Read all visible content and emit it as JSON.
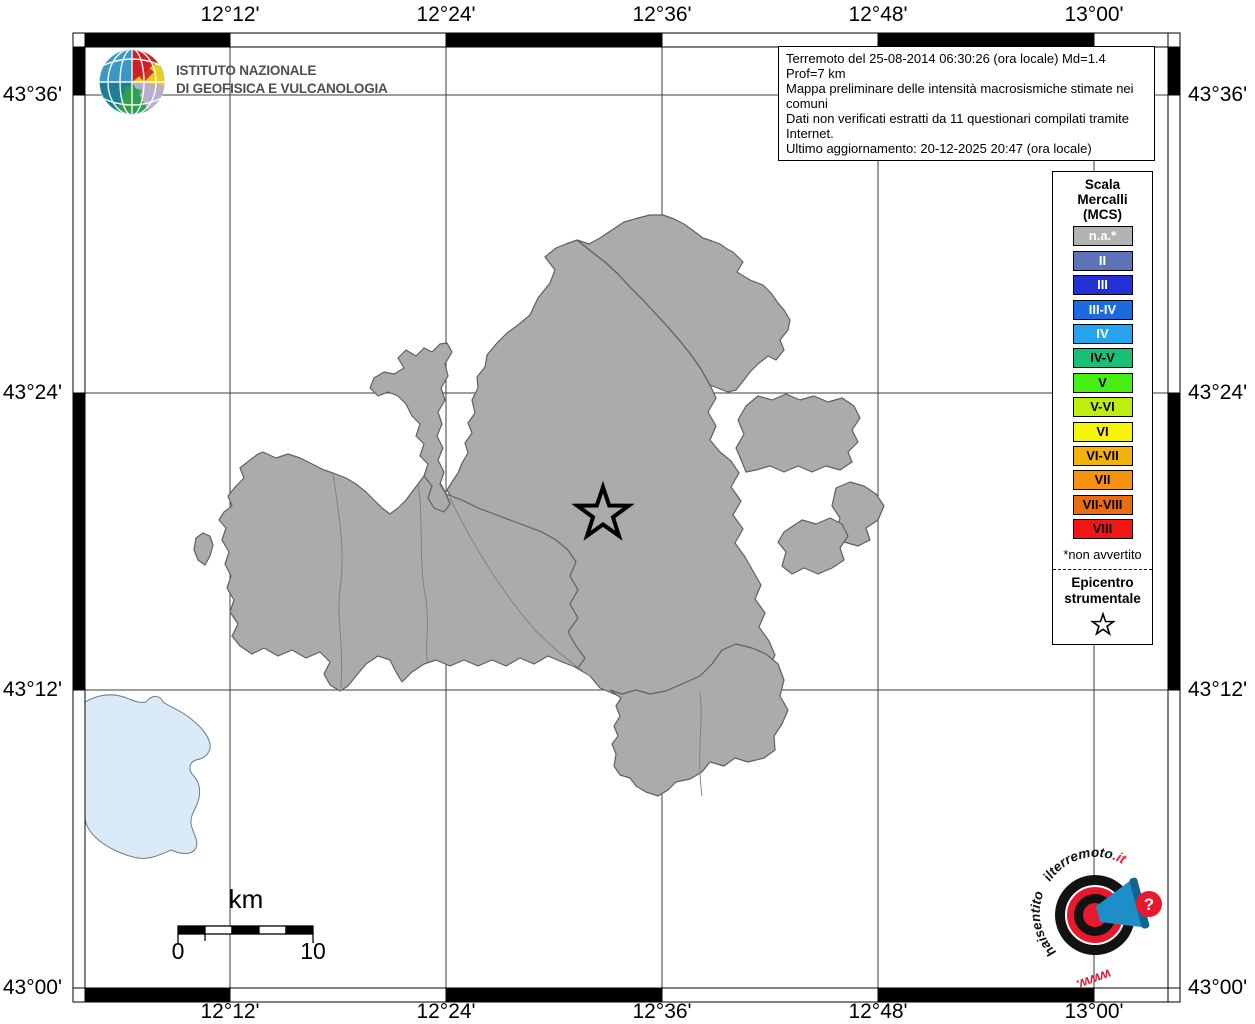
{
  "colors": {
    "land_fill": "#ababab",
    "land_border": "#606060",
    "lake_fill": "#daeaf8",
    "grid_line": "#3e3e3e",
    "logo_red": "#e8192c",
    "logo_blue": "#1e8ec8"
  },
  "ingv_logo": {
    "line1": "ISTITUTO NAZIONALE",
    "line2": "DI GEOFISICA E VULCANOLOGIA"
  },
  "info_box": {
    "lines": [
      "Terremoto del 25-08-2014 06:30:26 (ora locale) Md=1.4 Prof=7 km",
      "Mappa preliminare delle intensità macrosismiche stimate nei comuni",
      "Dati non verificati estratti da 11 questionari compilati tramite Internet.",
      "Ultimo aggiornamento: 20-12-2025 20:47 (ora locale)"
    ]
  },
  "axes": {
    "top": [
      "12°12'",
      "12°24'",
      "12°36'",
      "12°48'",
      "13°00'"
    ],
    "bottom": [
      "12°12'",
      "12°24'",
      "12°36'",
      "12°48'",
      "13°00'"
    ],
    "left": [
      "43°36'",
      "43°24'",
      "43°12'",
      "43°00'"
    ],
    "right": [
      "43°36'",
      "43°24'",
      "43°12'",
      "43°00'"
    ]
  },
  "legend": {
    "title_lines": [
      "Scala",
      "Mercalli",
      "(MCS)"
    ],
    "items": [
      {
        "label": "n.a.*",
        "bg": "#b2b2b2",
        "fg": "#ffffff"
      },
      {
        "label": "II",
        "bg": "#5e72b8",
        "fg": "#ffffff"
      },
      {
        "label": "III",
        "bg": "#2331d4",
        "fg": "#ffffff"
      },
      {
        "label": "III-IV",
        "bg": "#1a6ae0",
        "fg": "#ffffff"
      },
      {
        "label": "IV",
        "bg": "#27a3ee",
        "fg": "#ffffff"
      },
      {
        "label": "IV-V",
        "bg": "#16c176",
        "fg": "#000000"
      },
      {
        "label": "V",
        "bg": "#46ef12",
        "fg": "#000000"
      },
      {
        "label": "V-VI",
        "bg": "#bdee0e",
        "fg": "#000000"
      },
      {
        "label": "VI",
        "bg": "#f7f50a",
        "fg": "#000000"
      },
      {
        "label": "VI-VII",
        "bg": "#f2b10c",
        "fg": "#000000"
      },
      {
        "label": "VII",
        "bg": "#f79110",
        "fg": "#000000"
      },
      {
        "label": "VII-VIII",
        "bg": "#ed6c10",
        "fg": "#000000"
      },
      {
        "label": "VIII",
        "bg": "#f31414",
        "fg": "#000000"
      }
    ],
    "footnote": "*non avvertito",
    "epicenter_lines": [
      "Epicentro",
      "strumentale"
    ]
  },
  "scale_bar": {
    "unit": "km",
    "start_label": "0",
    "end_label": "10"
  },
  "watermark": {
    "arc_left": "haisentito",
    "arc_top": "ilterremoto",
    "arc_top_suffix": ".it",
    "bottom": "www.",
    "question": "?"
  }
}
